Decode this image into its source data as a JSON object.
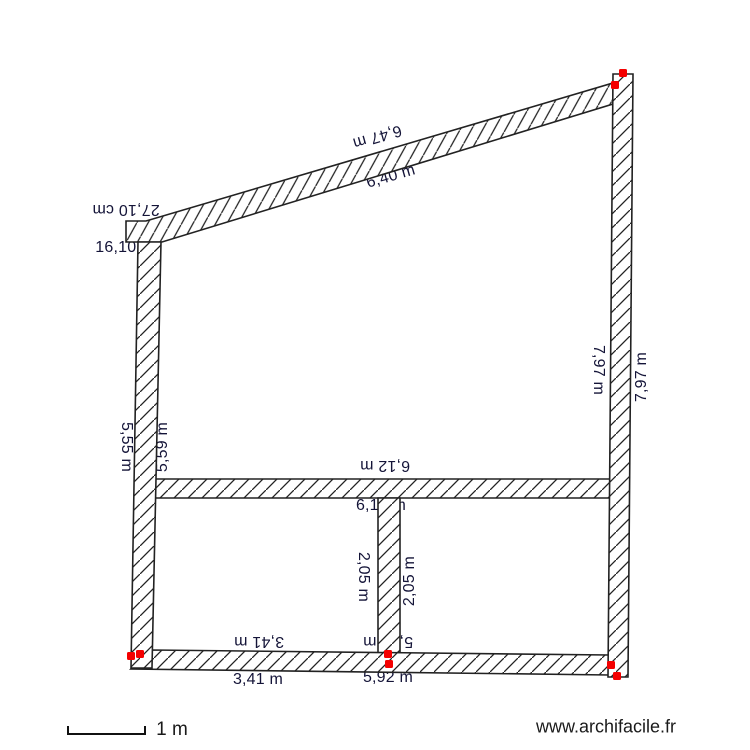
{
  "plan": {
    "watermark": "www.archifacile.fr",
    "scale_label": "1 m"
  },
  "dimensions": {
    "top_outer": "6,47 m",
    "top_inner": "6,40 m",
    "step_outer": "27,10 cm",
    "step_inner": "16,10 cm",
    "left_outer": "5,55 m",
    "left_inner": "5,59 m",
    "right_inner": "7,97 m",
    "right_outer": "7,97 m",
    "mid_upper": "6,12 m",
    "mid_lower": "6,12 m",
    "partition_left": "2,05 m",
    "partition_right": "2,05 m",
    "bottom_left_upper": "3,41 m",
    "bottom_left_lower": "3,41 m",
    "bottom_right_upper": "5,92 m",
    "bottom_right_lower": "5,92 m"
  },
  "colors": {
    "wall_outline": "#222222",
    "hatch_line": "#222222",
    "dimension_text": "#141438",
    "endpoint_handle": "#f40000"
  }
}
